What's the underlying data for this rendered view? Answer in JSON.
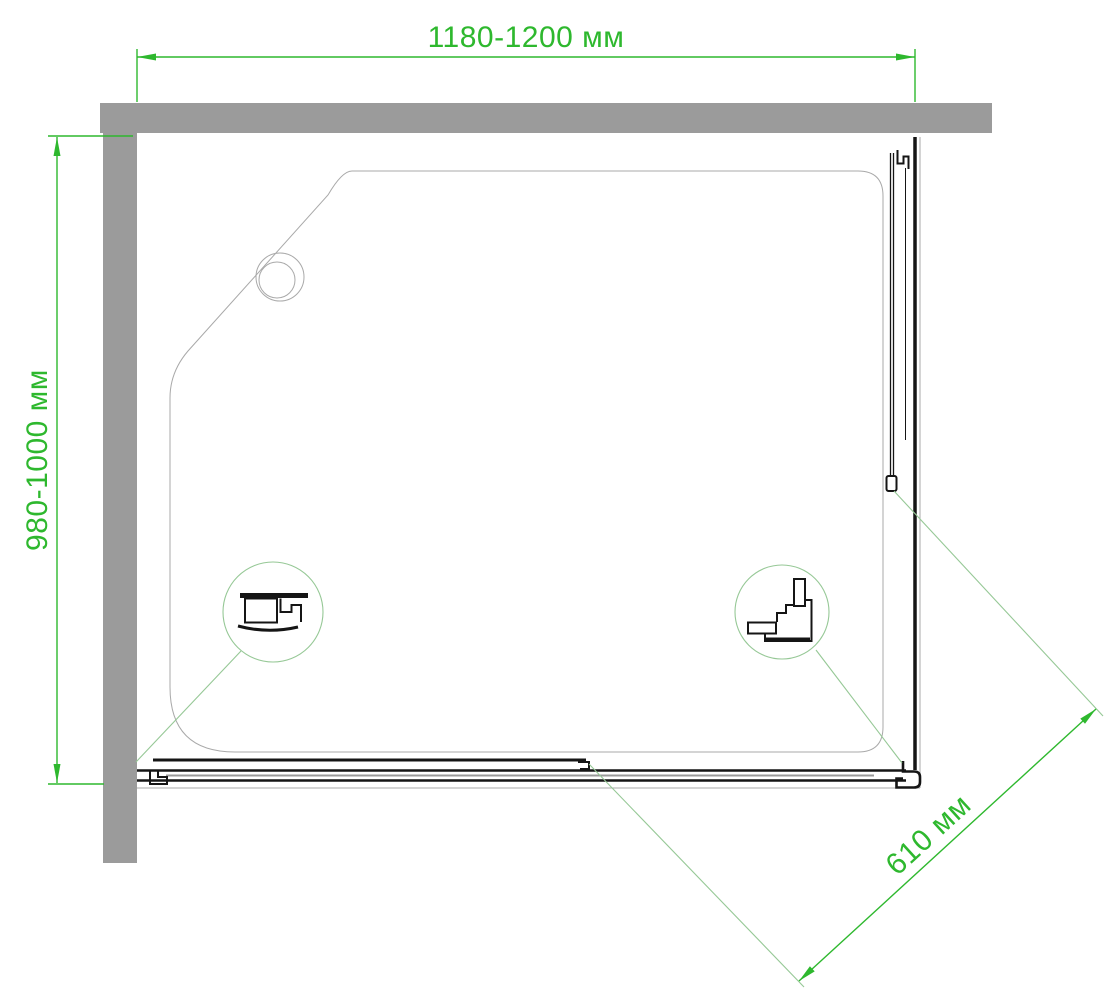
{
  "drawing": {
    "type": "shower-enclosure-top-view-installation-diagram",
    "units": "мм",
    "dimensions": {
      "width": {
        "label": "1180-1200 мм",
        "orientation": "horizontal-top"
      },
      "depth": {
        "label": "980-1000 мм",
        "orientation": "vertical-left"
      },
      "door_opening": {
        "label": "610 мм",
        "orientation": "diagonal-bottom-right"
      }
    },
    "callouts": [
      {
        "name": "door-rail-profile-detail",
        "position": "bottom-left-of-tray"
      },
      {
        "name": "corner-connector-profile-detail",
        "position": "bottom-right-of-tray"
      }
    ],
    "parts": [
      "top-wall",
      "left-wall",
      "shower-tray",
      "drain",
      "fixed-glass-panel",
      "right-frame-rail",
      "corner-connector",
      "sliding-door-panel",
      "inner-door-panel",
      "bottom-door-rail",
      "left-wall-profile"
    ],
    "colors": {
      "dimension_green": "#2eb82e",
      "leader_green": "#96c896",
      "wall_gray": "#9b9b9b",
      "line_dark": "#151515",
      "line_light": "#a9a9a9",
      "glass_gray": "#999999",
      "background": "#ffffff"
    }
  }
}
